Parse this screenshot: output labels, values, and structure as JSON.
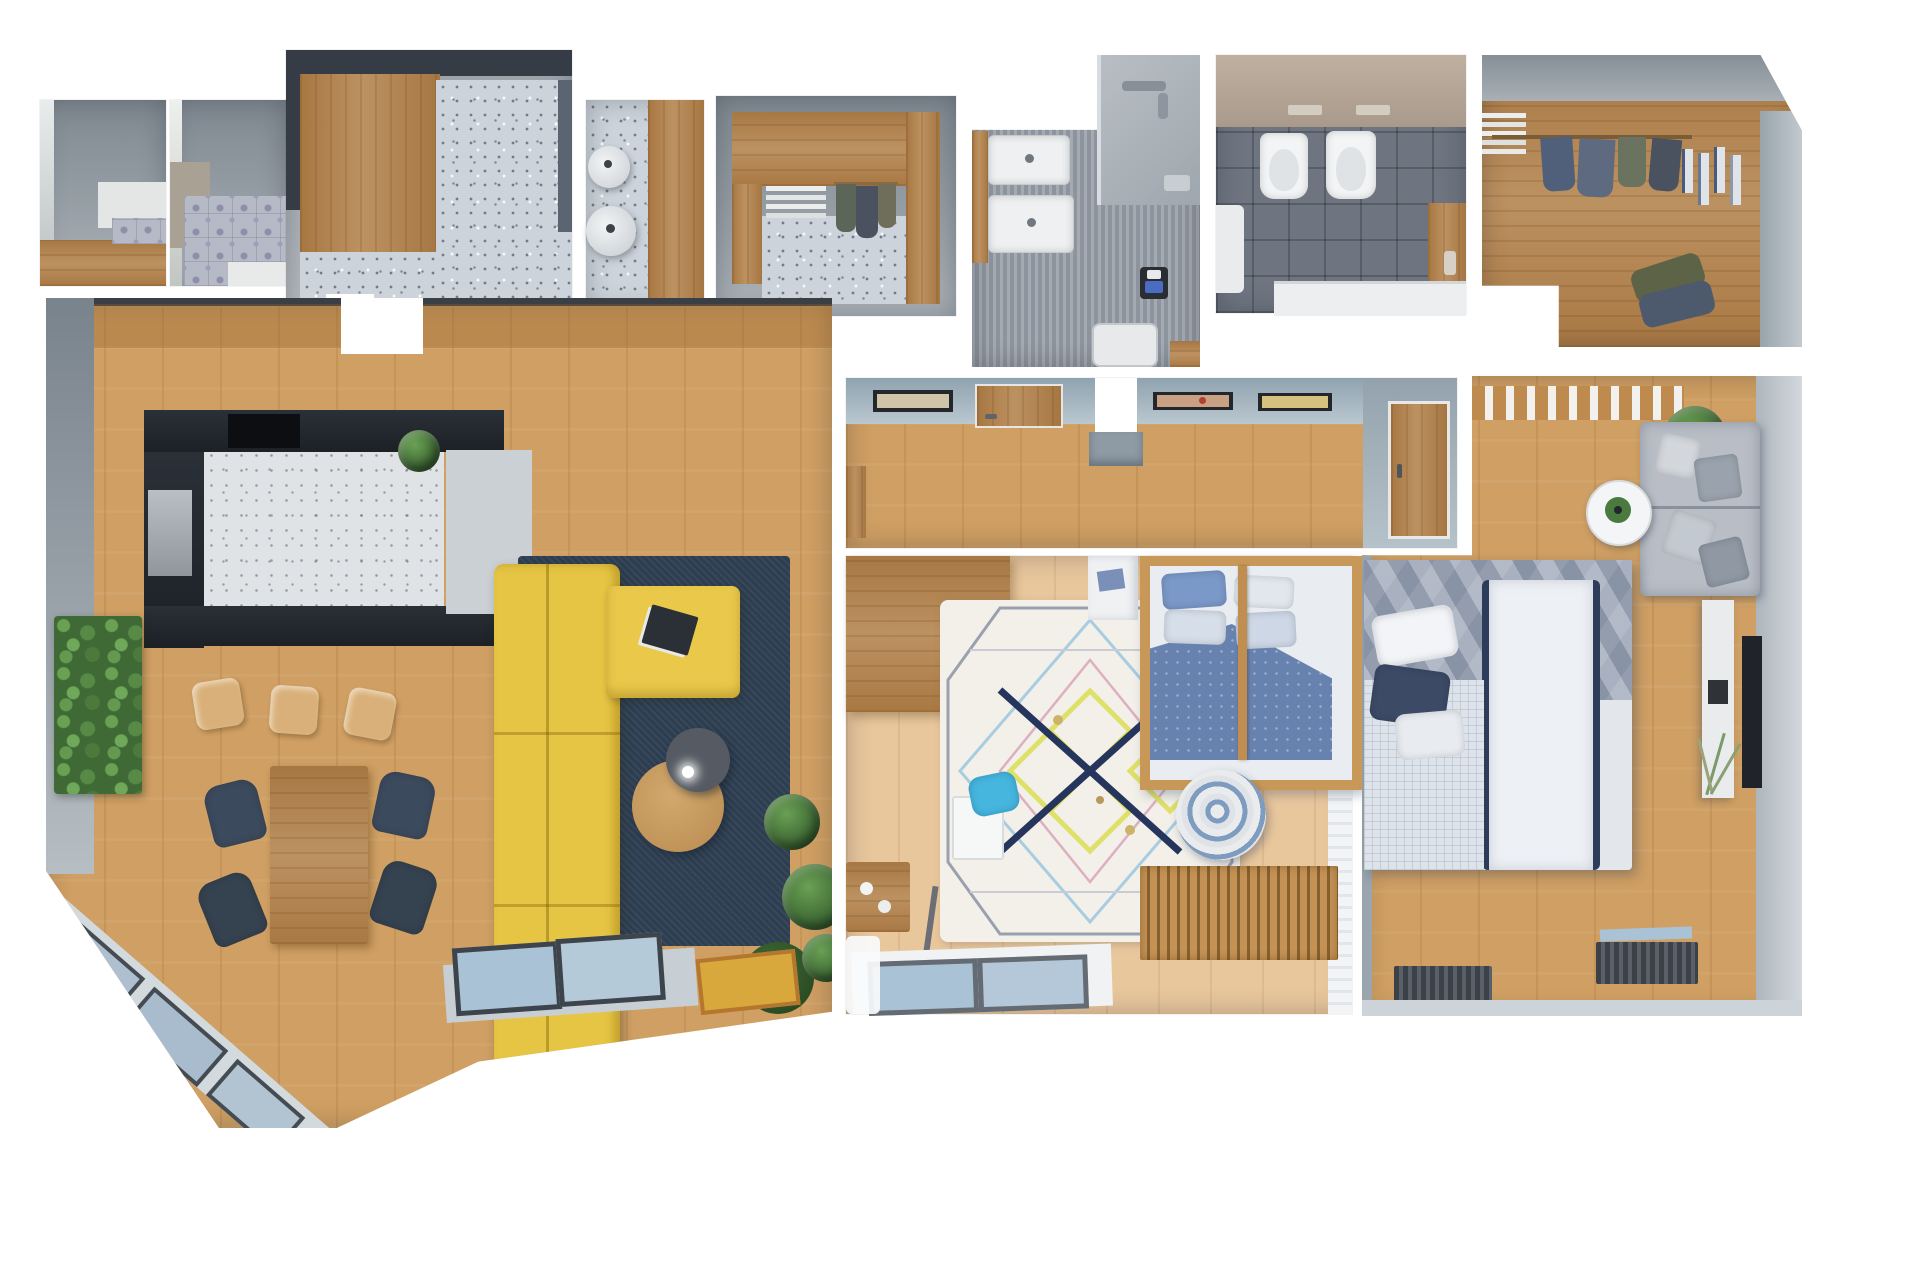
{
  "meta": {
    "label": "Top-down 3D render of an apartment floor plan, rooms separated by white gaps",
    "width_px": 1912,
    "height_px": 1275,
    "visible_text": "none"
  },
  "palette": {
    "bg": "#ffffff",
    "wall_dark": "#363c46",
    "wall_grey": "#8e979e",
    "wall_light": "#c6cdd3",
    "wall_blue": "#9fb0bc",
    "wood_cab": "#b5854f",
    "wood_floor": "#cf9f63",
    "wood_light": "#d9b079",
    "wood_bed1_floor": "#e9c79d",
    "terrazzo_base": "#ccd3da",
    "terrazzo_dot": "#707c8a",
    "tile_base": "#b6b9c6",
    "stone_floor": "#9aa1a9",
    "dark_tile": "#6e7580",
    "kitchen_dark": "#23282e",
    "rug_navy": "#2d3e51",
    "sofa_yellow": "#e7c544",
    "chair_navy": "#3c4a5d",
    "plant_green": "#4e7c41",
    "white_fixture": "#eef0f2",
    "bed_blue": "#6882b0",
    "bed_grey": "#96a0b2",
    "duvet_white": "#edf0f4",
    "navy_deep": "#2e3c5c",
    "mat_yellow": "#d8a83c",
    "glass_blue": "#a9c2d6",
    "sofa_grey": "#b9bec6",
    "pouf_blue": "#7d9cbf",
    "rug_white": "#f3f0ea",
    "rug_pat_yellow": "#dfe069",
    "rug_pat_pink": "#dcb0c0",
    "rug_pat_blue": "#a8cce0",
    "rug_pat_grey": "#9aa0ae"
  },
  "rooms": {
    "laundry_nook": {
      "label": "utility nook with grey walls and wood floor strip"
    },
    "tile_bath_nook": {
      "label": "bathroom corner with patterned cement tiles"
    },
    "entry": {
      "label": "entry hall with dark walls, wood wardrobe and terrazzo floor"
    },
    "hall_strip": {
      "label": "hall strip with two round pendant lamps and wood panel"
    },
    "closet": {
      "label": "small walk-in closet with shelves and hanging clothes"
    },
    "bath_sinks": {
      "label": "bathroom with double washbasin and walk-in shower"
    },
    "bath_toilets": {
      "label": "bathroom with toilet, bidet, washbasin and bathtub"
    },
    "wardrobe": {
      "label": "L-shaped walk-in wardrobe with hanging rails"
    },
    "living": {
      "label": "open-plan living room with kitchen, dining table and yellow sofa"
    },
    "corridor": {
      "label": "corridor with framed pictures and doors"
    },
    "bedroom_child": {
      "label": "bedroom with canopy bed, geometric rug and desk"
    },
    "bedroom_master": {
      "label": "master bedroom with double bed, grey sofa and TV console"
    }
  },
  "furniture": {
    "entry": [
      "built-in-wardrobe",
      "terrazzo-floor",
      "door-opening"
    ],
    "hall_strip": [
      "pendant-lamp",
      "pendant-lamp",
      "wood-panel"
    ],
    "closet": [
      "shelf-stack",
      "clothes-rail",
      "hanging-clothes"
    ],
    "bath_sinks": [
      "washbasin",
      "washbasin",
      "wood-shelf",
      "shower-area",
      "shower-tray",
      "toilet-brush-set",
      "wood-stool"
    ],
    "bath_toilets": [
      "toilet",
      "bidet",
      "flush-plate",
      "flush-plate",
      "washbasin",
      "bathtub",
      "wood-cabinet"
    ],
    "wardrobe": [
      "shelf-stack",
      "hanging-clothes",
      "belt-rack",
      "clothes-pile"
    ],
    "living": [
      "kitchen-counter",
      "oven-niche",
      "fridge-cabinet",
      "bar-stool",
      "bar-stool",
      "bar-stool",
      "vertical-garden",
      "dining-table",
      "dining-chair",
      "dining-chair",
      "dining-chair",
      "dining-chair",
      "navy-rug",
      "yellow-corner-sofa",
      "magazine",
      "coffee-table",
      "side-table",
      "potted-plant",
      "potted-plant",
      "potted-plant",
      "potted-plant",
      "window",
      "window",
      "yellow-doormat"
    ],
    "corridor": [
      "picture-frame",
      "picture-frame",
      "picture-frame",
      "wood-door",
      "wood-door",
      "wall-pillar"
    ],
    "bedroom_child": [
      "desk",
      "geometric-rug",
      "kids-table",
      "blue-chair",
      "play-table",
      "easel",
      "canopy-bed",
      "pillow",
      "pillow",
      "pillow",
      "pillow",
      "wall-shelf",
      "striped-pouf",
      "slatted-bench",
      "window",
      "curtain"
    ],
    "bedroom_master": [
      "slatted-wardrobe-top",
      "potted-plant",
      "grey-sofa",
      "cushions",
      "round-side-table",
      "double-bed",
      "pillow",
      "pillow",
      "pillow",
      "white-console",
      "tv-panel",
      "decorative-branches",
      "floor-grille",
      "floor-grille",
      "window-sill"
    ]
  }
}
